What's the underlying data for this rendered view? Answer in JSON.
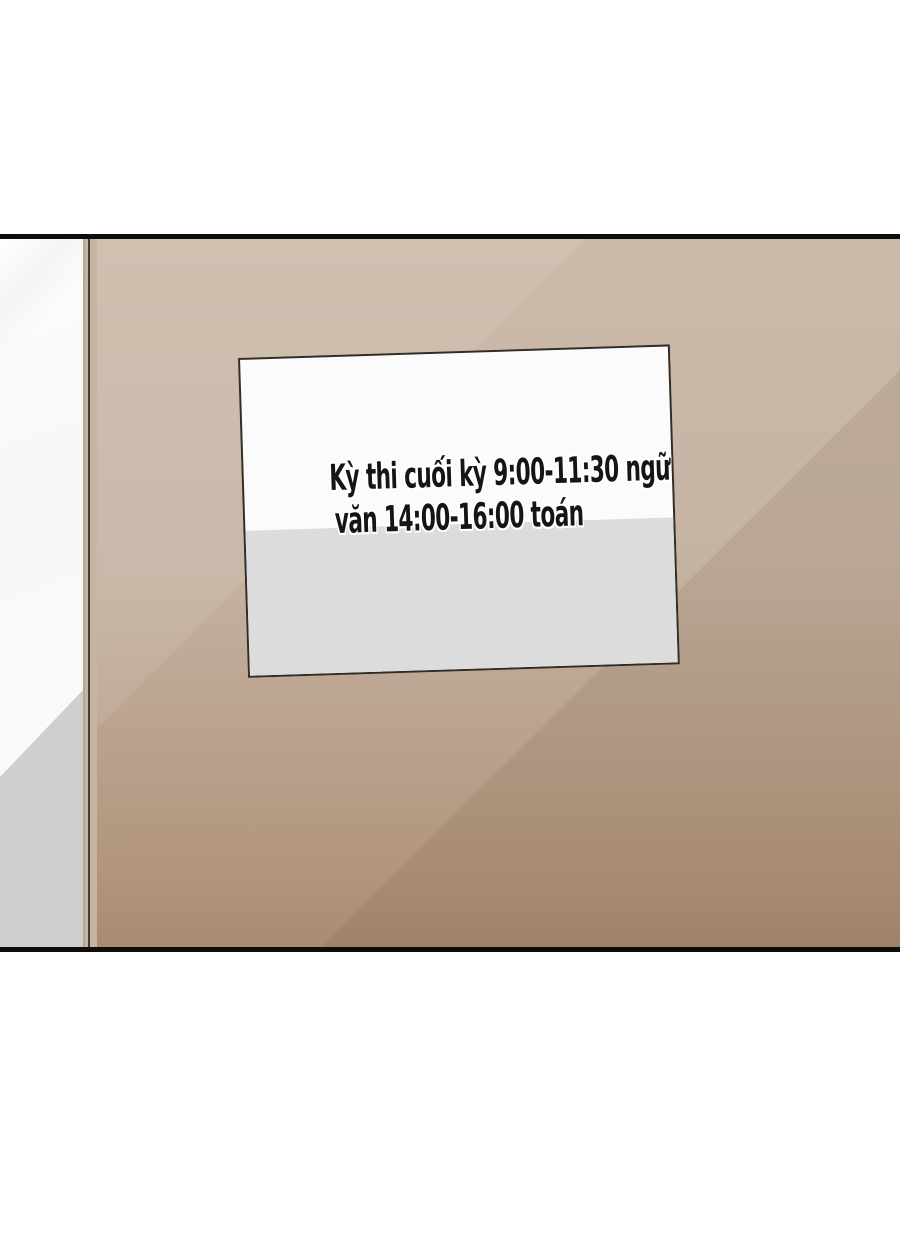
{
  "scene": {
    "description": "comic panel of a tan wall with a posted exam schedule notice",
    "notice": {
      "line1": "Kỳ thi cuối kỳ 9:00-11:30 ngữ",
      "line2": "văn 14:00-16:00 toán"
    },
    "colors": {
      "panel_border": "#0f0d0b",
      "wall_top": "#cbbaa9",
      "wall_bottom": "#a98b72",
      "wall_frame": "#c6b4a4",
      "frame_line_dark": "#453c33",
      "strip_white": "#fdfdfd",
      "strip_gray": "#cfcfcf",
      "paper_white": "#fbfbfb",
      "paper_gray": "#dcdcdc",
      "paper_border": "#332c25",
      "text": "#151515"
    }
  }
}
